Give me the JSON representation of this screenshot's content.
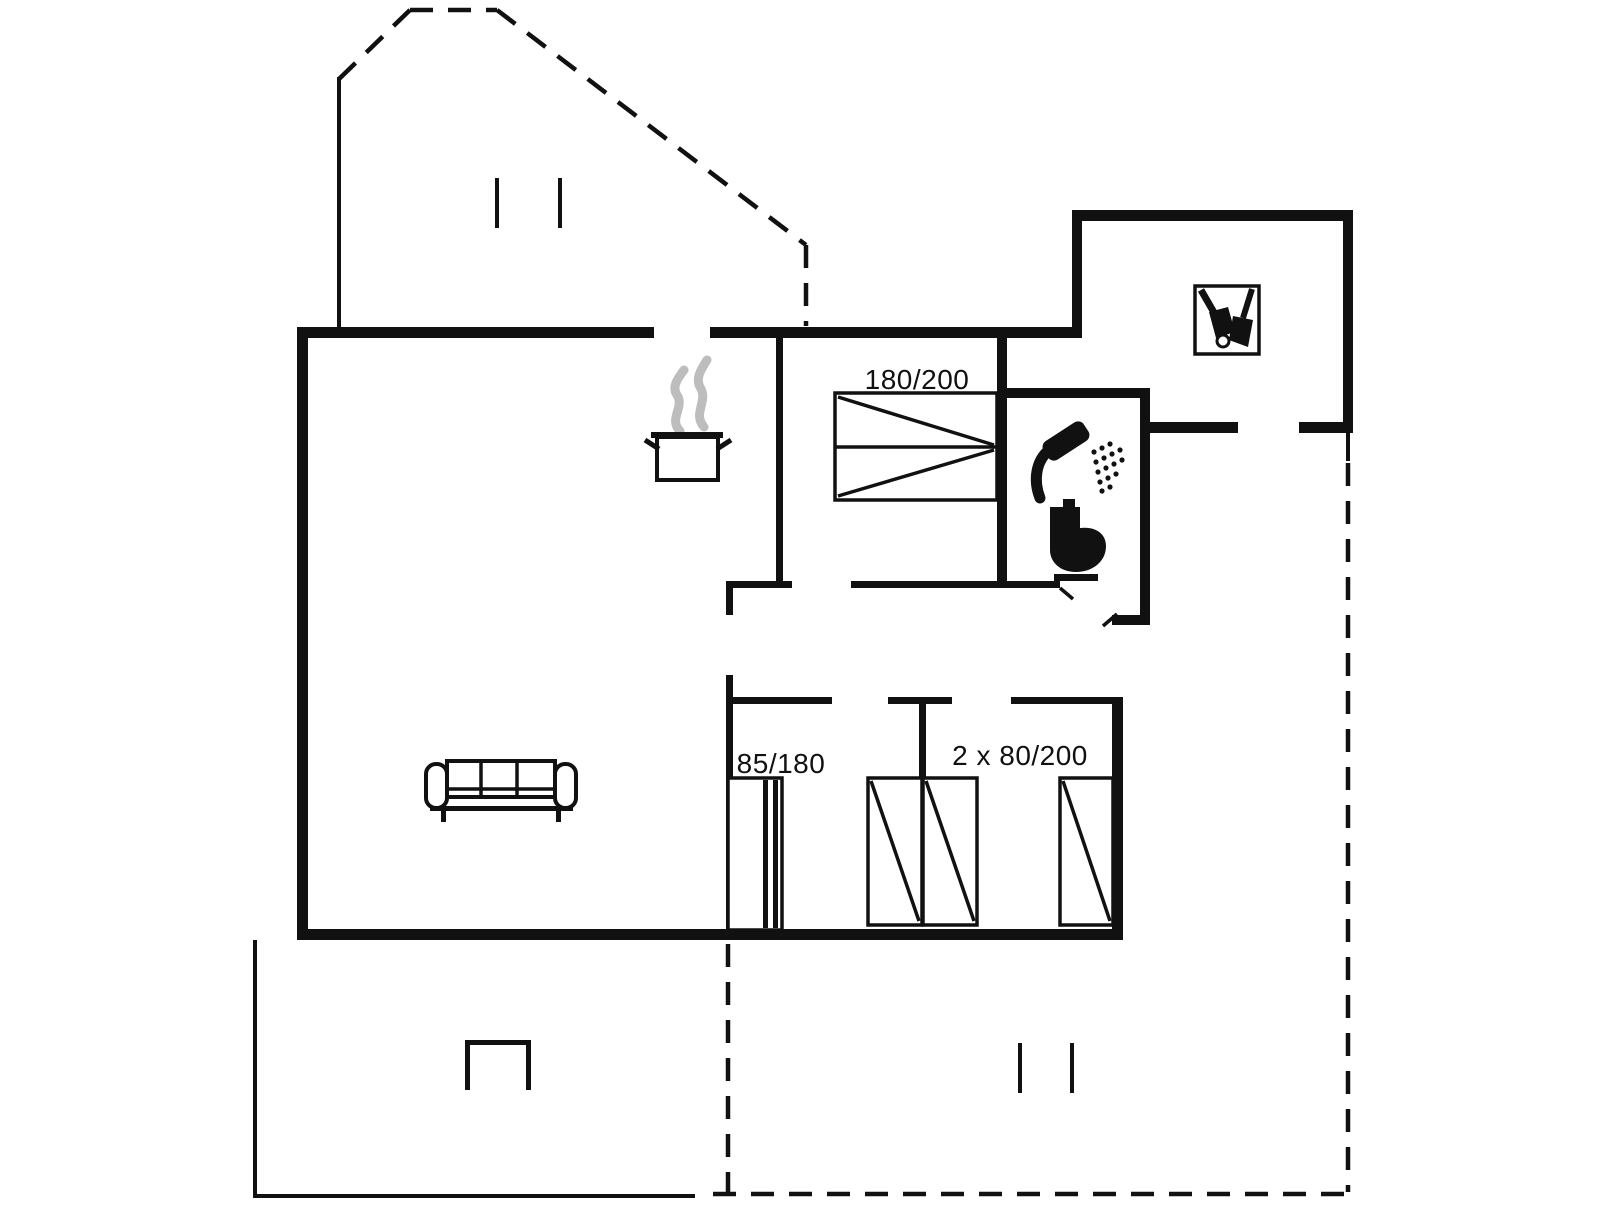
{
  "plan": {
    "type": "holiday-house-floor-plan",
    "colors": {
      "line": "#111111",
      "steam": "#bdbdbd",
      "background": "#ffffff"
    },
    "labels": {
      "double_bed_size": "180/200",
      "single_bed_size": "85/180",
      "twin_bed_size": "2 x 80/200"
    },
    "icons": {
      "kitchen": "cooking-pot-icon",
      "bathroom": [
        "shower-icon",
        "toilet-icon"
      ],
      "entry": "cleaning-tools-icon",
      "living_room": "sofa-icon"
    }
  }
}
